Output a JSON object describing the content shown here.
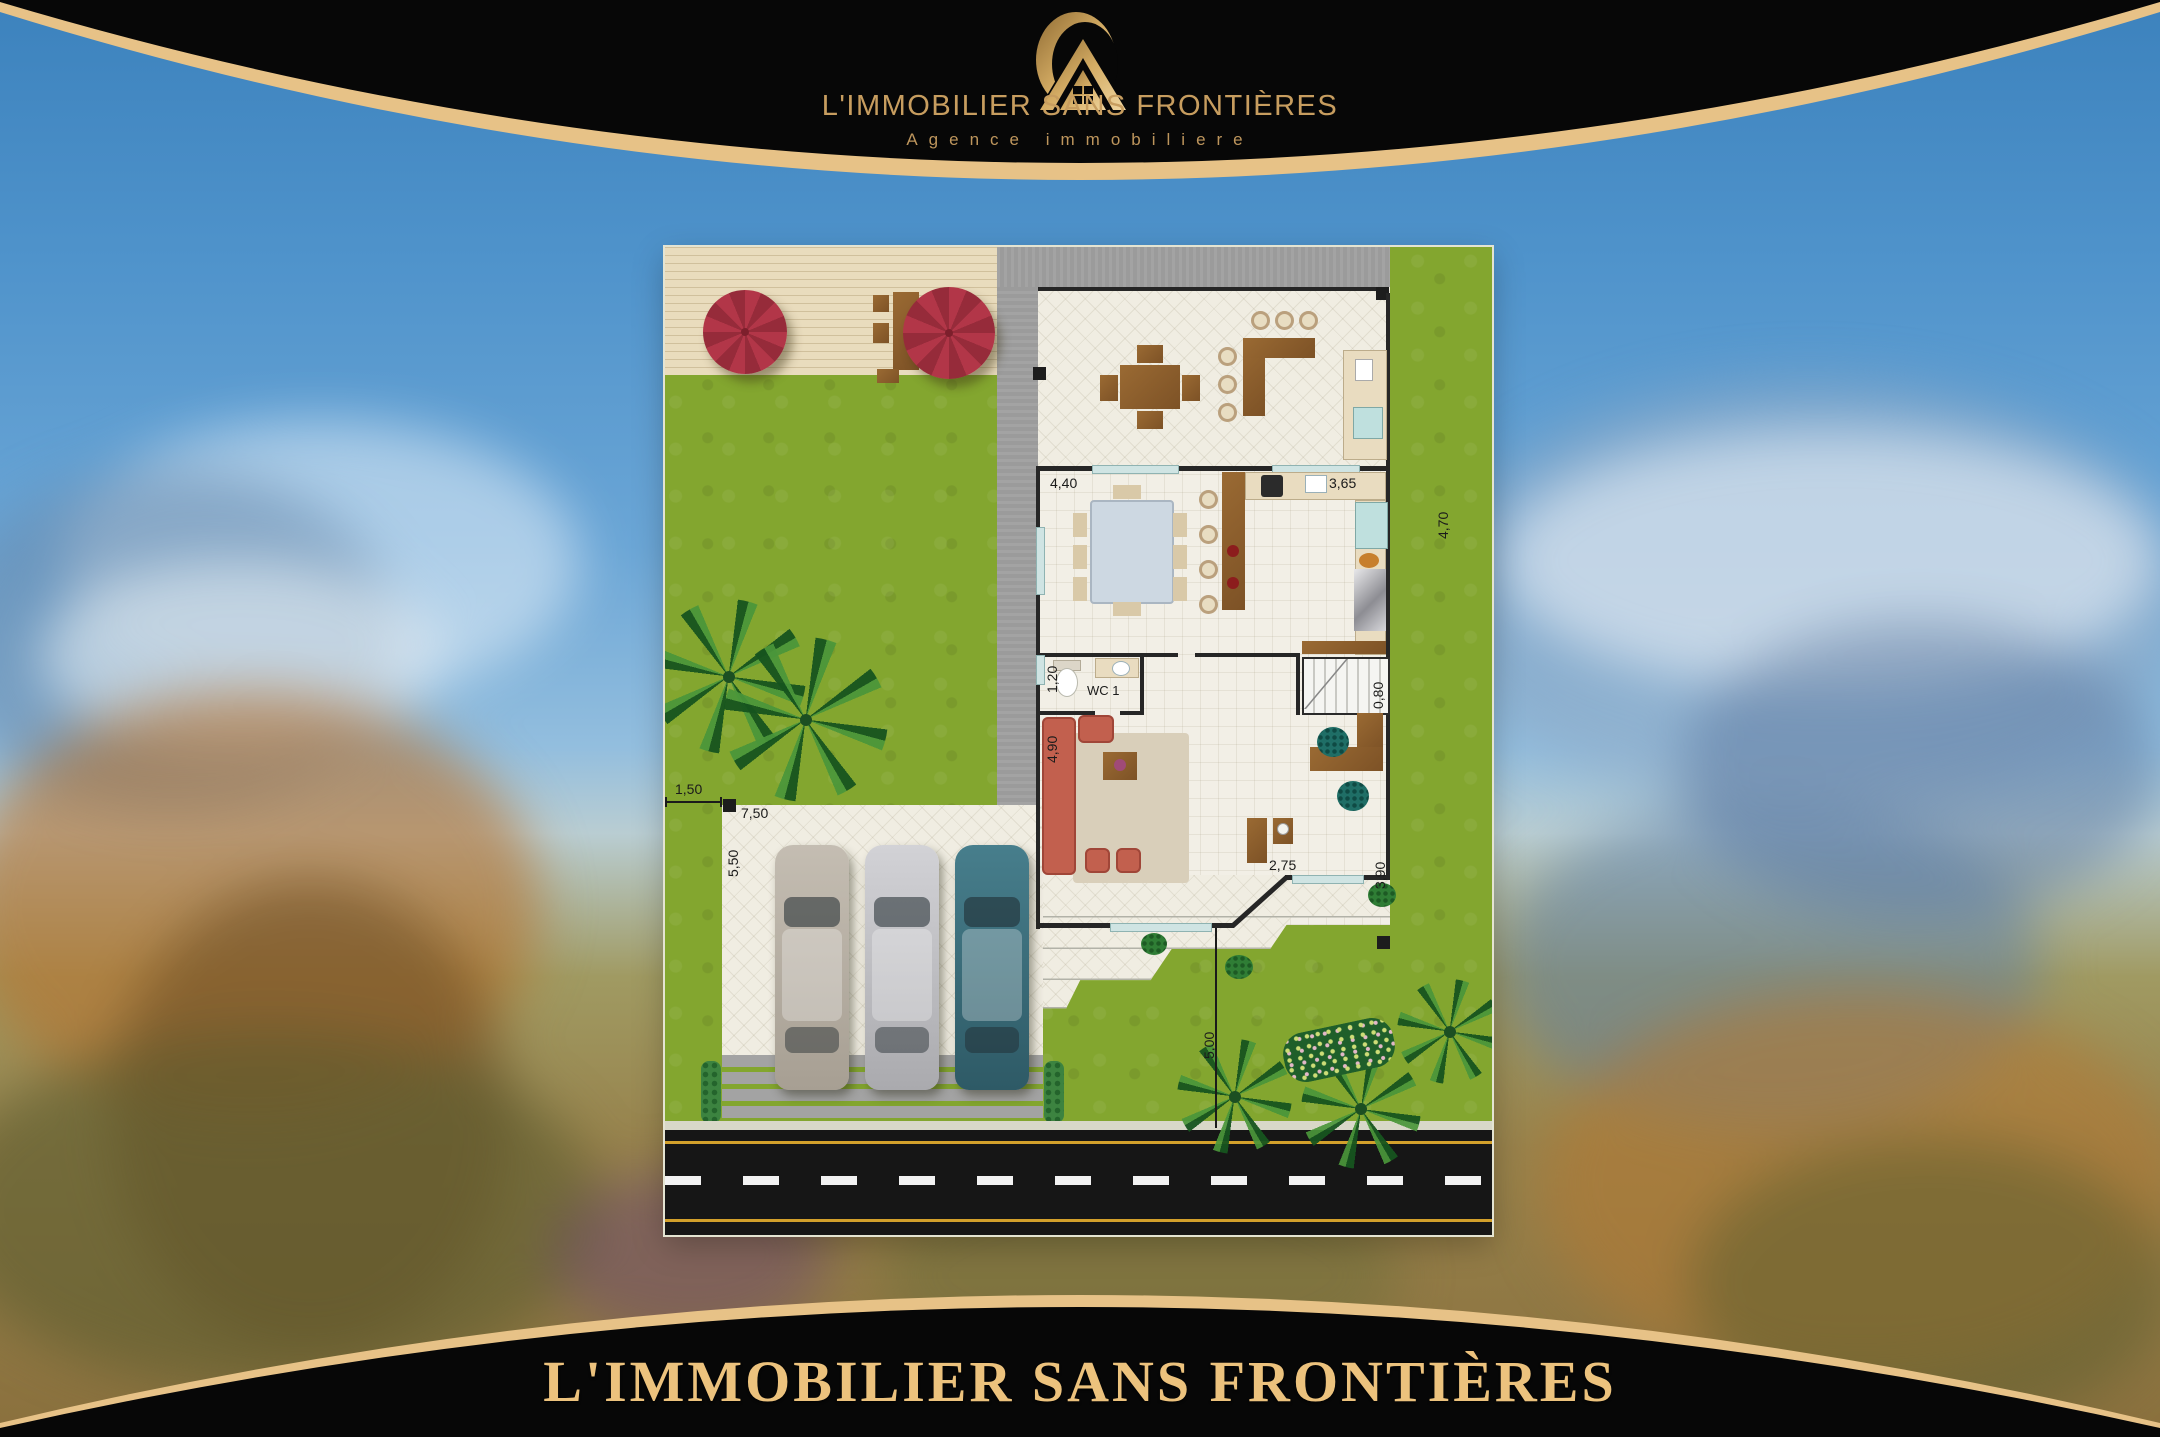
{
  "branding": {
    "logo_icon": "house-logo-icon",
    "title": "L'IMMOBILIER SANS FRONTIÈRES",
    "subtitle": "Agence immobiliere"
  },
  "footer": {
    "title": "L'IMMOBILIER SANS FRONTIÈRES"
  },
  "floor_plan": {
    "room_labels": {
      "wc": "WC 1"
    },
    "dimensions": [
      {
        "id": "dining-width",
        "label": "4,40"
      },
      {
        "id": "kitchen-width",
        "label": "3,65"
      },
      {
        "id": "kitchen-depth",
        "label": "4,70"
      },
      {
        "id": "wc-width",
        "label": "1,20"
      },
      {
        "id": "living-depth",
        "label": "4,90"
      },
      {
        "id": "stairs-width",
        "label": "0,80"
      },
      {
        "id": "office-width",
        "label": "2,75"
      },
      {
        "id": "office-depth",
        "label": "3,90"
      },
      {
        "id": "front-setback",
        "label": "5,00"
      },
      {
        "id": "side-setback",
        "label": "1,50"
      },
      {
        "id": "garage-width",
        "label": "7,50"
      },
      {
        "id": "garage-depth",
        "label": "5,50"
      }
    ]
  },
  "colors": {
    "gold_band": "#e7c287",
    "gold_text": "#c79d5f",
    "footer_gold": "#ecc27d",
    "header_black": "#070707",
    "sky": "#4f93cb",
    "lawn": "#83a62f",
    "deck": "#e9dcbd",
    "sidewalk": "#9b9b9b",
    "floor_tile": "#f0ede2",
    "wall": "#262626",
    "road": "#161616",
    "road_yellow": "#d2a02b",
    "umbrella_red": "#b23648",
    "sofa_terracotta": "#c2604e",
    "wood_brown": "#8a5a2d",
    "window_teal": "#cfe4e3",
    "car_beige": "#b3aca4",
    "car_silver": "#c6c6ca",
    "car_teal": "#3e7280"
  }
}
